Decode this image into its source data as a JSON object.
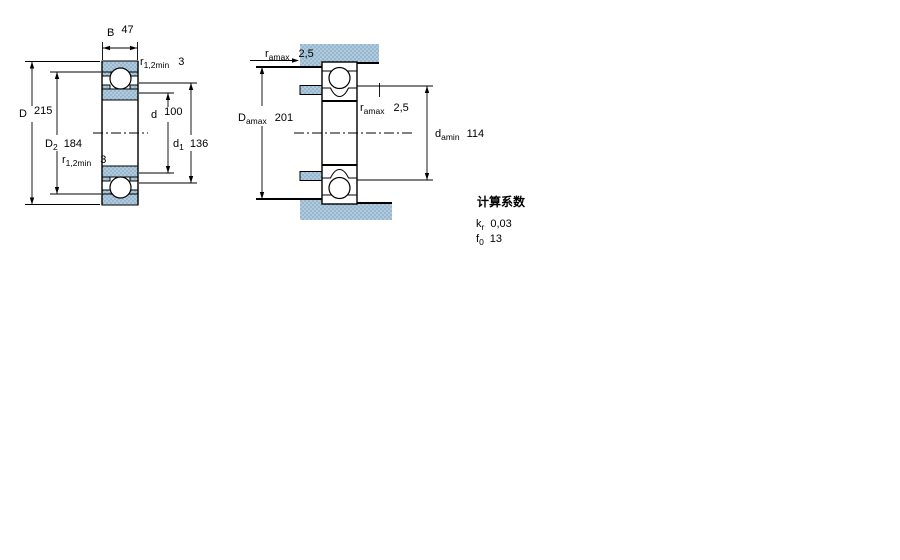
{
  "colors": {
    "part_fill": "#b0cbdd",
    "part_dot": "#86a9c4",
    "line_color": "#000000",
    "page_background": "#ffffff"
  },
  "front_view": {
    "dims": {
      "B": {
        "symbol": "B",
        "sub": "",
        "value": "47"
      },
      "r12min_top": {
        "symbol": "r",
        "sub": "1,2min",
        "value": "3"
      },
      "D": {
        "symbol": "D",
        "sub": "",
        "value": "215"
      },
      "D2": {
        "symbol": "D",
        "sub": "2",
        "value": "184"
      },
      "d": {
        "symbol": "d",
        "sub": "",
        "value": "100"
      },
      "d1": {
        "symbol": "d",
        "sub": "1",
        "value": "136"
      },
      "r12min_bottom": {
        "symbol": "r",
        "sub": "1,2min",
        "value": "3"
      }
    }
  },
  "mounted_view": {
    "dims": {
      "ra_top": {
        "symbol": "r",
        "sub": "amax",
        "value": "2,5"
      },
      "Da": {
        "symbol": "D",
        "sub": "amax",
        "value": "201"
      },
      "ra_mid": {
        "symbol": "r",
        "sub": "amax",
        "value": "2,5"
      },
      "da": {
        "symbol": "d",
        "sub": "amin",
        "value": "114"
      }
    }
  },
  "calculation_factors": {
    "heading": "计算系数",
    "rows": [
      {
        "symbol": "k",
        "sub": "r",
        "value": "0,03"
      },
      {
        "symbol": "f",
        "sub": "0",
        "value": "13"
      }
    ]
  }
}
